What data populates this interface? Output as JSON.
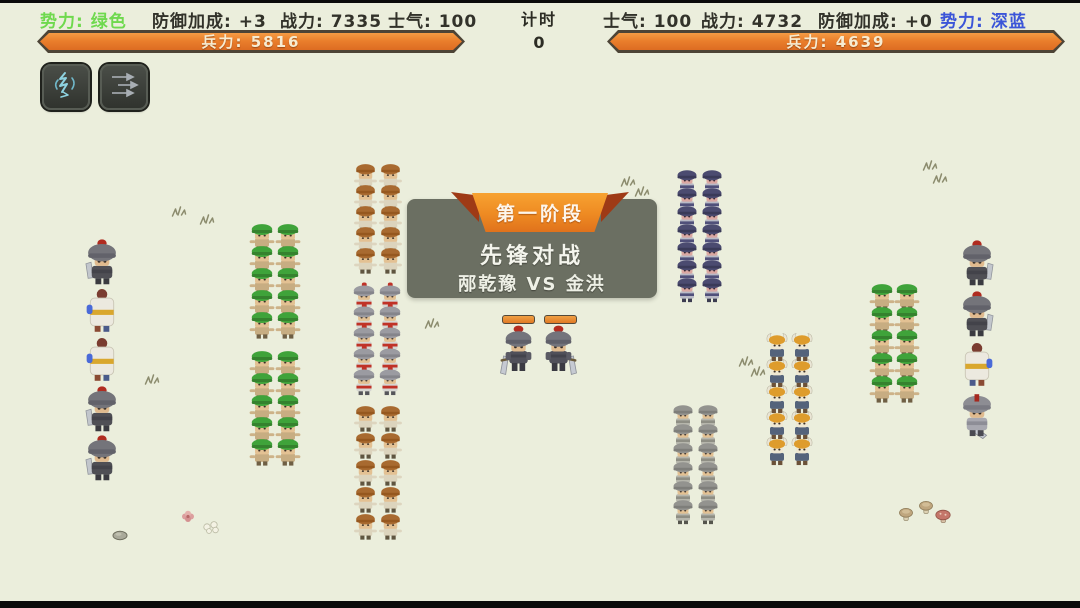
{
  "colors": {
    "background": "#ebeedc",
    "hud_text": "#32322a",
    "faction_green": "#6fd94e",
    "faction_blue": "#3b55d8",
    "bar_fill_orange": "#e2761e",
    "bar_border": "#4d4436",
    "banner_panel_gray": "#6f7366",
    "ribbon_orange": "#ee8a22",
    "ribbon_fold_red": "#9e3a16"
  },
  "header": {
    "left": {
      "faction": "势力: 绿色",
      "defense": "防御加成: +3",
      "power": "战力: 7335",
      "morale": "士气: 100",
      "troops": "兵力: 5816"
    },
    "timer": {
      "label": "计时",
      "value": "0"
    },
    "right": {
      "morale": "士气: 100",
      "power": "战力: 4732",
      "defense": "防御加成: +0",
      "faction": "势力: 深蓝",
      "troops": "兵力: 4639"
    }
  },
  "skills": [
    {
      "icon": "cavalry-lightning-icon"
    },
    {
      "icon": "arrow-volley-icon"
    }
  ],
  "banner": {
    "phase": "第一阶段",
    "title": "先锋对战",
    "matchup": "邴乾豫 VS 金洪"
  },
  "battlefield": {
    "groups": [
      {
        "name": "left-flank-column",
        "types": [
          "gray_knight",
          "white_robe",
          "white_robe",
          "gray_knight",
          "gray_knight"
        ],
        "x": 83,
        "y": 238,
        "cols": 1,
        "rows": 5,
        "px": 0,
        "py": 49,
        "w": 38,
        "h": 47
      },
      {
        "name": "green-block-upper",
        "type": "green_hood",
        "x": 248,
        "y": 222,
        "cols": 2,
        "rows": 5,
        "px": 26,
        "py": 22,
        "w": 28,
        "h": 30
      },
      {
        "name": "green-block-lower",
        "type": "green_hood",
        "x": 248,
        "y": 349,
        "cols": 2,
        "rows": 5,
        "px": 26,
        "py": 22,
        "w": 28,
        "h": 30
      },
      {
        "name": "militia-top",
        "type": "brown_hair",
        "x": 352,
        "y": 162,
        "cols": 2,
        "rows": 5,
        "px": 25,
        "py": 21,
        "w": 27,
        "h": 29
      },
      {
        "name": "silver-red-guard",
        "type": "silver_red_plume",
        "x": 350,
        "y": 282,
        "cols": 2,
        "rows": 5,
        "px": 26,
        "py": 21,
        "w": 28,
        "h": 30
      },
      {
        "name": "militia-bottom",
        "type": "brown_hair",
        "x": 352,
        "y": 404,
        "cols": 2,
        "rows": 5,
        "px": 25,
        "py": 27,
        "w": 27,
        "h": 29
      },
      {
        "name": "blue-guard-top",
        "type": "dark_blue_guard",
        "x": 674,
        "y": 167,
        "cols": 2,
        "rows": 7,
        "px": 25,
        "py": 18,
        "w": 26,
        "h": 28
      },
      {
        "name": "silver-guard-bottom",
        "type": "silver_guard",
        "x": 670,
        "y": 402,
        "cols": 2,
        "rows": 6,
        "px": 25,
        "py": 19,
        "w": 26,
        "h": 28
      },
      {
        "name": "viking-block",
        "type": "horned_viking",
        "x": 763,
        "y": 332,
        "cols": 2,
        "rows": 5,
        "px": 25,
        "py": 26,
        "w": 28,
        "h": 30
      },
      {
        "name": "green-block-right",
        "type": "green_hood",
        "x": 868,
        "y": 282,
        "cols": 2,
        "rows": 5,
        "px": 25,
        "py": 23,
        "w": 28,
        "h": 30
      },
      {
        "name": "right-flank-column",
        "types": [
          "gray_knight",
          "gray_knight",
          "white_robe",
          "great_sword"
        ],
        "x": 958,
        "y": 239,
        "cols": 1,
        "rows": 4,
        "px": 0,
        "py": 51,
        "w": 38,
        "h": 47,
        "mirror": true
      }
    ],
    "duelists": [
      {
        "side": "left",
        "x": 500,
        "y": 324,
        "w": 37,
        "h": 56,
        "mirror": true,
        "hp": {
          "x": 502,
          "y": 315,
          "w": 31,
          "h": 7
        }
      },
      {
        "side": "right",
        "x": 540,
        "y": 324,
        "w": 37,
        "h": 56,
        "mirror": false,
        "hp": {
          "x": 544,
          "y": 315,
          "w": 31,
          "h": 7
        }
      }
    ],
    "decorations": [
      {
        "kind": "grass",
        "x": 170,
        "y": 203
      },
      {
        "kind": "grass",
        "x": 198,
        "y": 211
      },
      {
        "kind": "grass",
        "x": 143,
        "y": 371
      },
      {
        "kind": "grass",
        "x": 423,
        "y": 315
      },
      {
        "kind": "grass",
        "x": 619,
        "y": 173
      },
      {
        "kind": "grass",
        "x": 633,
        "y": 183
      },
      {
        "kind": "grass",
        "x": 737,
        "y": 353
      },
      {
        "kind": "grass",
        "x": 749,
        "y": 363
      },
      {
        "kind": "grass",
        "x": 921,
        "y": 157
      },
      {
        "kind": "grass",
        "x": 931,
        "y": 170
      },
      {
        "kind": "rock",
        "x": 112,
        "y": 526
      },
      {
        "kind": "flower_pink",
        "x": 180,
        "y": 509
      },
      {
        "kind": "flower_white",
        "x": 202,
        "y": 519
      },
      {
        "kind": "mushroom_tan",
        "x": 898,
        "y": 506
      },
      {
        "kind": "mushroom_tan",
        "x": 918,
        "y": 499
      },
      {
        "kind": "mushroom_red",
        "x": 934,
        "y": 508
      }
    ]
  }
}
